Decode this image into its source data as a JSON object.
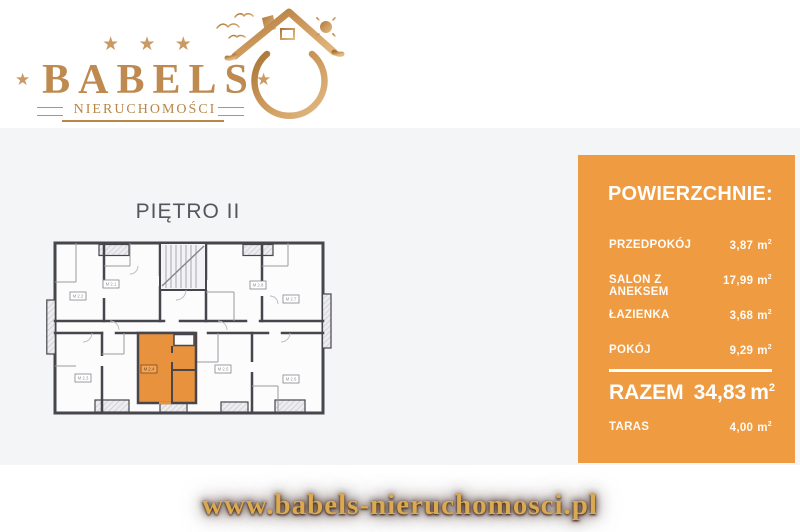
{
  "logo": {
    "brand": "BABELS",
    "subtitle": "NIERUCHOMOŚCI",
    "stars_top": "★ ★ ★",
    "star": "★"
  },
  "floorplan": {
    "title": "PIĘTRO II",
    "highlighted_unit": "M 2.4",
    "units": [
      {
        "id": "M 2.2"
      },
      {
        "id": "M 2.1"
      },
      {
        "id": "M 2.8"
      },
      {
        "id": "M 2.7"
      },
      {
        "id": "M 2.3"
      },
      {
        "id": "M 2.4"
      },
      {
        "id": "M 2.5"
      },
      {
        "id": "M 2.6"
      }
    ]
  },
  "areas_panel": {
    "heading": "POWIERZCHNIE:",
    "unit": "m",
    "unit_sup": "2",
    "rows": [
      {
        "label": "PRZEDPOKÓJ",
        "value": "3,87"
      },
      {
        "label": "SALON Z ANEKSEM",
        "value": "17,99"
      },
      {
        "label": "ŁAZIENKA",
        "value": "3,68"
      },
      {
        "label": "POKÓJ",
        "value": "9,29"
      }
    ],
    "total": {
      "label": "RAZEM",
      "value": "34,83"
    },
    "extra": {
      "label": "TARAS",
      "value": "4,00"
    }
  },
  "footer": {
    "website": "www.babels-nieruchomosci.pl"
  },
  "colors": {
    "panel_orange": "#EE9B41",
    "unit_highlight": "#E8923E",
    "logo_gold": "#BE8A50",
    "background_gray": "#F4F5F7",
    "wall_dark": "#46464C"
  }
}
